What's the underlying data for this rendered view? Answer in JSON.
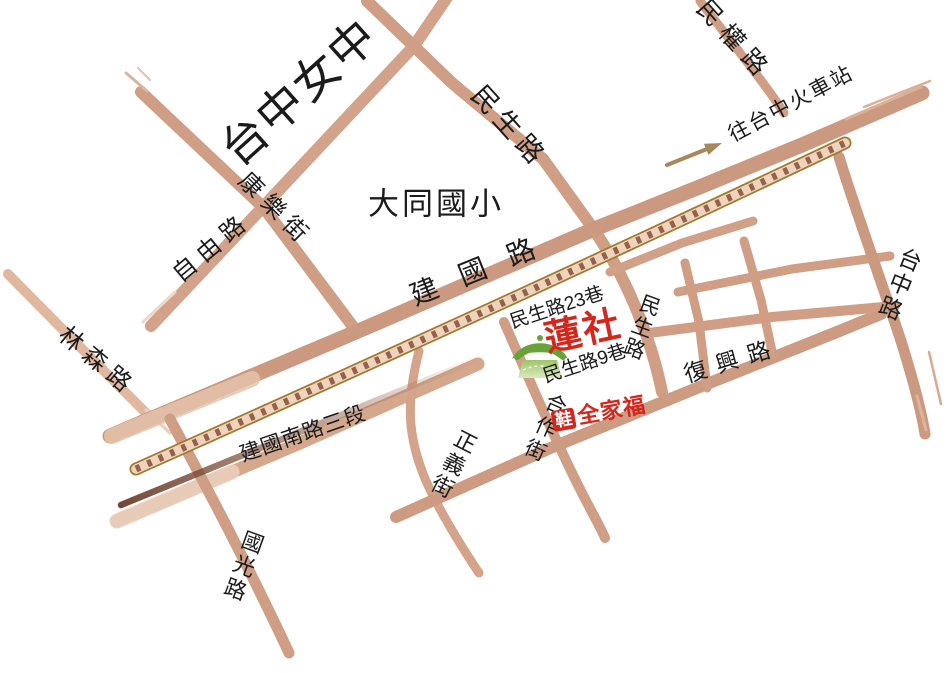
{
  "labels": {
    "taichung_girls_high": "台中女中",
    "datong_elementary": "大同國小",
    "jianguo_rd": "建國路",
    "jianguo_s_rd_sec3": "建國南路三段",
    "minsheng_rd_nw": "民生路",
    "minsheng_rd_s": "民生路",
    "minquan_rd": "民權路",
    "to_taichung_station": "往台中火車站",
    "ziyou_rd": "自由路",
    "kangle_st": "康樂街",
    "linsen_rd": "林森路",
    "guoguang_rd": "國光路",
    "zhengyi_st": "正義街",
    "hezuo_st": "合作街",
    "fuxing_rd": "復興路",
    "taichung_rd": "台中路",
    "minsheng_lane23": "民生路23巷",
    "minsheng_lane9": "民生路9巷",
    "lotus_society": "蓮社",
    "shoe_store_badge": "鞋",
    "shoe_store_name": "全家福"
  },
  "icons": {
    "temple": "green-pagoda-temple-icon",
    "station_arrow": "right-arrow-to-station"
  },
  "colors": {
    "road_tan": "#cf9e85",
    "road_dark_tan": "#cb9980",
    "road_light": "#e5c3ad",
    "railway_border": "#a1782e",
    "railway_fill": "#efd4bd",
    "railway_tie": "#96614b",
    "dark_brush": "#6b3e2d",
    "accent_red": "#d6251b",
    "temple_green": "#68a33a",
    "arrow_olive": "#a6885c",
    "text": "#1b1b1b"
  }
}
